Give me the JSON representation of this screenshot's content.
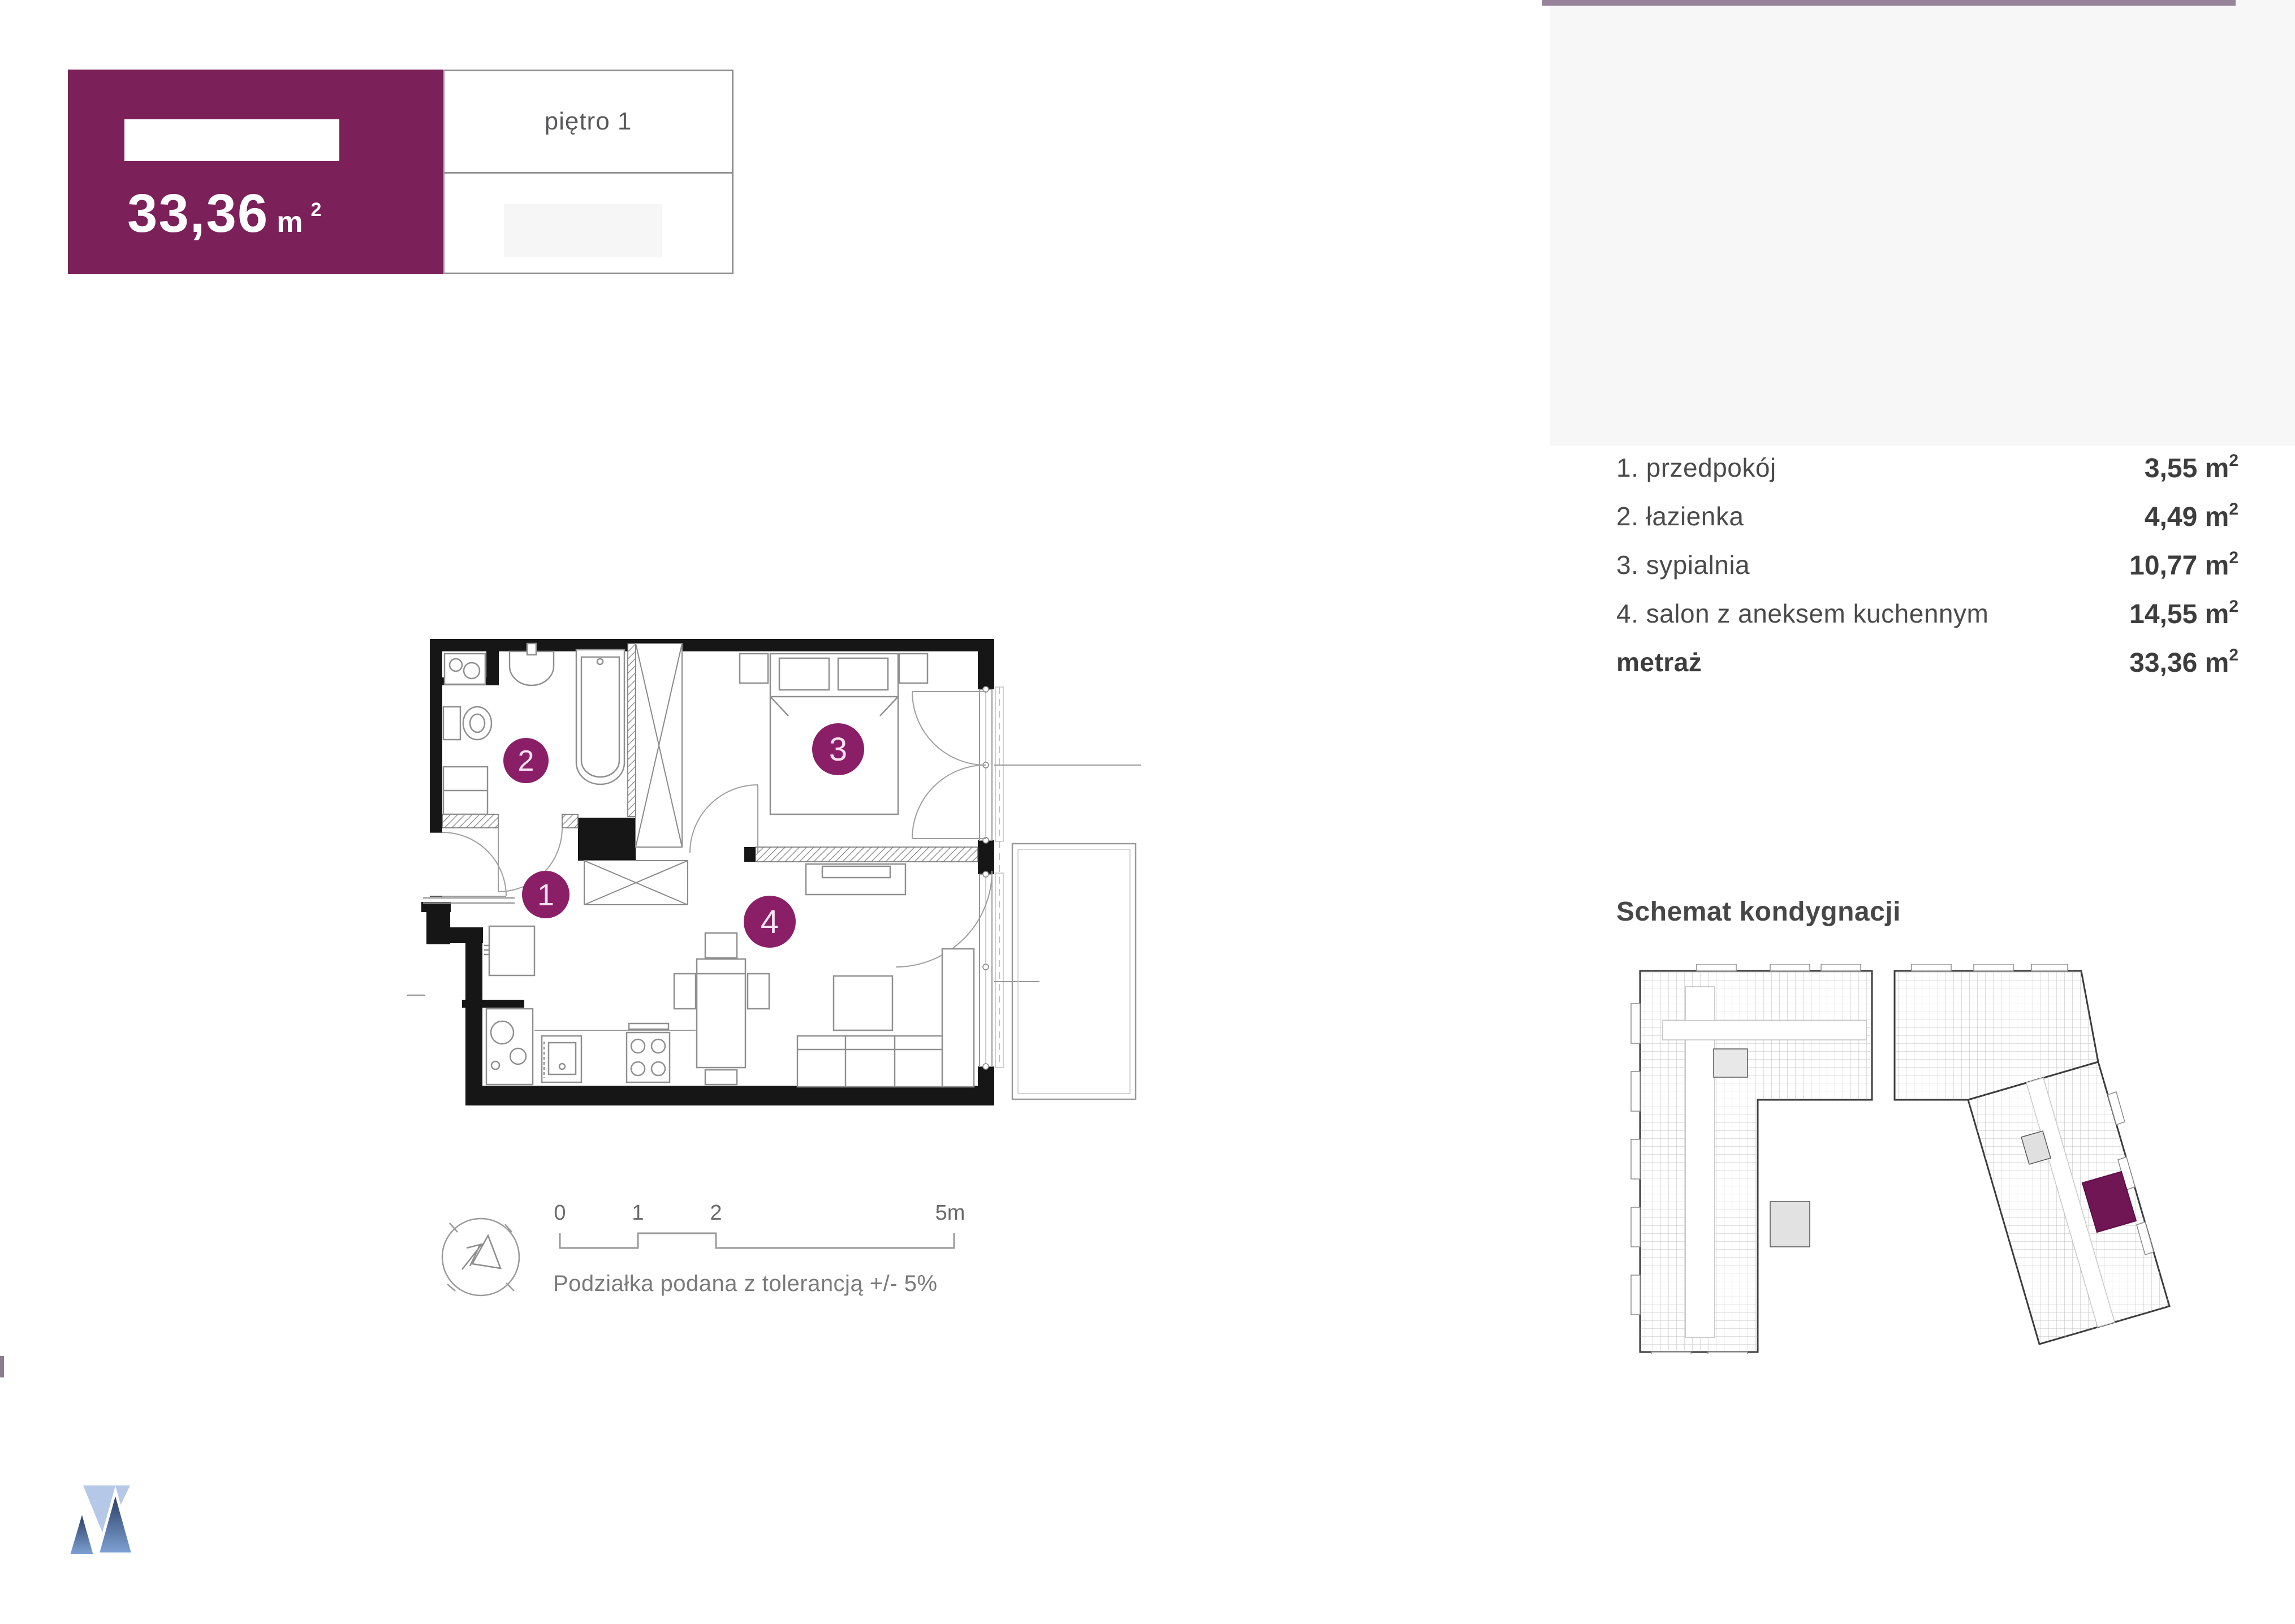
{
  "header": {
    "area_value": "33,36",
    "area_unit_base": "m",
    "area_unit_sup": "2",
    "floor_label": "piętro 1"
  },
  "room_list": {
    "rows": [
      {
        "label": "1. przedpokój",
        "value": "3,55",
        "unit_base": "m",
        "unit_sup": "2"
      },
      {
        "label": "2. łazienka",
        "value": "4,49",
        "unit_base": "m",
        "unit_sup": "2"
      },
      {
        "label": "3. sypialnia",
        "value": "10,77",
        "unit_base": "m",
        "unit_sup": "2"
      },
      {
        "label": "4. salon z aneksem kuchennym",
        "value": "14,55",
        "unit_base": "m",
        "unit_sup": "2"
      }
    ],
    "total": {
      "label": "metraż",
      "value": "33,36",
      "unit_base": "m",
      "unit_sup": "2"
    }
  },
  "floor_plan": {
    "room_numbers": [
      "1",
      "2",
      "3",
      "4"
    ]
  },
  "scale_bar": {
    "ticks": [
      "0",
      "1",
      "2",
      "5m"
    ],
    "caption": "Podziałka podana z tolerancją +/- 5%"
  },
  "section": {
    "title": "Schemat kondygnacji"
  },
  "colors": {
    "header_purple": "#7b2059",
    "circle_purple": "#8a1f68",
    "schematic_highlight": "#701655",
    "top_line_mauve": "#97839a",
    "wall_black": "#161616",
    "logo_blue_dark": "#22355c",
    "logo_blue_light": "#7fa3d4",
    "logo_blue_pale": "#b5c8e8",
    "panel_gray": "#f7f7f7"
  }
}
